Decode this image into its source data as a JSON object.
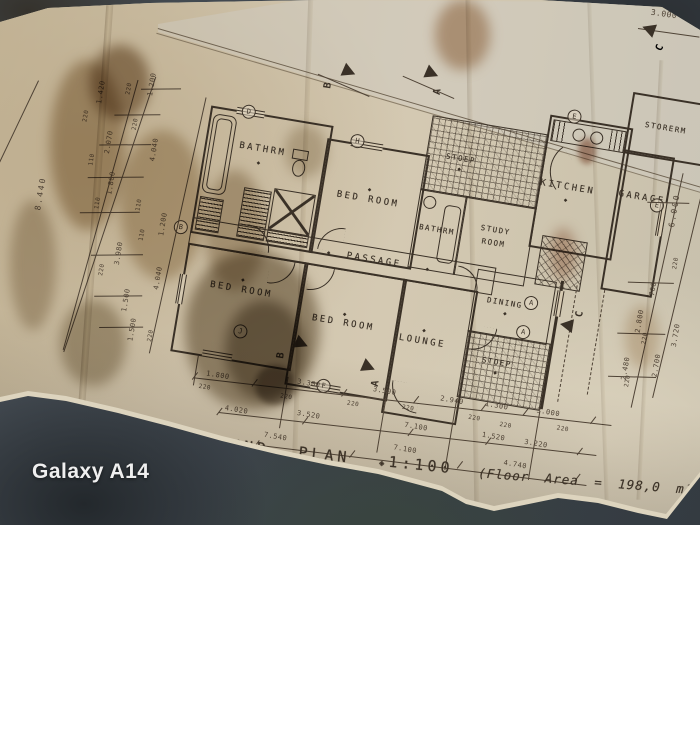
{
  "photo": {
    "watermark": "Galaxy A14"
  },
  "title_block": {
    "title": "GROUND PLAN",
    "scale_marker": "◈",
    "scale": "1:100",
    "floor_area": "(Floor Area = 198,0 m²)"
  },
  "rooms": [
    {
      "label": "BATHRM"
    },
    {
      "label": "BED ROOM"
    },
    {
      "label": "STOEP"
    },
    {
      "label": "BATHRM"
    },
    {
      "label": "STUDY ROOM"
    },
    {
      "label": "KITCHEN"
    },
    {
      "label": "STORERM"
    },
    {
      "label": "GARAGE"
    },
    {
      "label": "PASSAGE"
    },
    {
      "label": "BED ROOM"
    },
    {
      "label": "BED ROOM"
    },
    {
      "label": "LOUNGE"
    },
    {
      "label": "DINING"
    },
    {
      "label": "STOEP"
    }
  ],
  "dims": {
    "wall": "220",
    "half_wall": "110",
    "bottom_row1": [
      "1.800",
      "3.300",
      "3.500",
      "2.940",
      "1.300",
      "3.000"
    ],
    "bottom_row2": [
      "4.020",
      "3.520",
      "7.100",
      "1.520",
      "3.220"
    ],
    "bottom_row3": [
      "7.540",
      "7.100",
      "4.740"
    ],
    "left": [
      "8.440",
      "1.200",
      "1.420",
      "2.070",
      "1.800",
      "1.200",
      "3.980",
      "4.040",
      "4.040",
      "1.500",
      "1.500"
    ],
    "right": [
      "6.000",
      "700",
      "2.800",
      "2.480",
      "2.700",
      "3.720"
    ],
    "top_right": "3.000"
  },
  "markers": {
    "diamond": "◆",
    "grid": [
      "D",
      "H",
      "E",
      "B",
      "E",
      "A",
      "A",
      "J",
      "F"
    ],
    "sections": [
      "B",
      "A",
      "C",
      "C",
      "B",
      "A"
    ]
  }
}
